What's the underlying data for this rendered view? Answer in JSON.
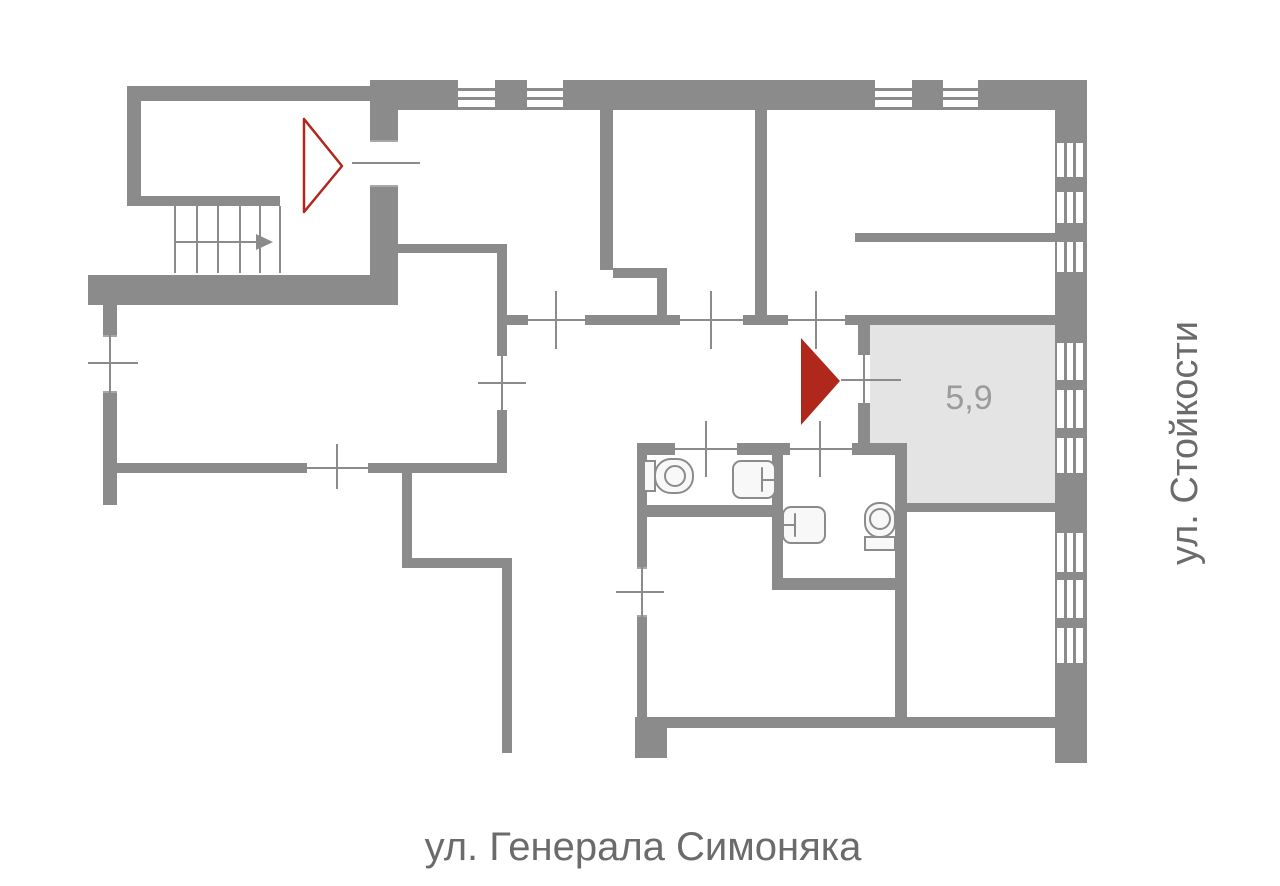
{
  "floor_plan": {
    "highlighted_room": {
      "area_label": "5,9"
    },
    "streets": {
      "bottom": "ул. Генерала Симоняка",
      "right": "ул. Стойкости"
    }
  },
  "colors": {
    "background": "#ffffff",
    "wall": "#8b8b8b",
    "highlight_fill": "#e4e4e4",
    "accent_red": "#b0271c",
    "street_text": "#6b6b6b",
    "area_text": "#9b9b9b",
    "fixture_fill": "#f8f8f8"
  },
  "icons": {
    "stairs": "stairs-with-up-arrow",
    "building_entrance": "red-triangle-outline",
    "apartment_entrance": "red-arrow-right",
    "toilet": "toilet-top-view",
    "sink": "sink-top-view",
    "window": "window-slats",
    "door": "opening-with-cross"
  }
}
